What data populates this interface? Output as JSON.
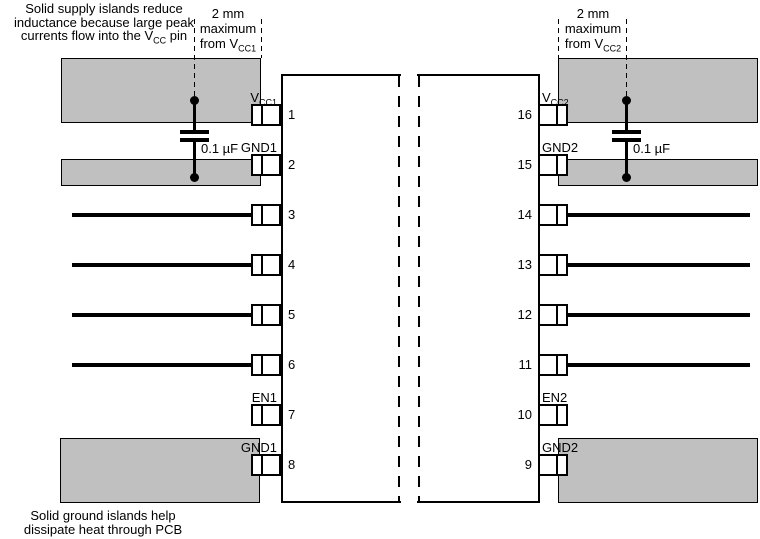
{
  "colors": {
    "island_fill": "#c0c0c0",
    "outline": "#000000",
    "background": "#ffffff"
  },
  "notes": {
    "supply": {
      "line1": "Solid supply islands reduce",
      "line2": "inductance because large peak",
      "line3_pre": "currents flow into the V",
      "line3_sub": "CC",
      "line3_post": " pin"
    },
    "ground": {
      "line1": "Solid ground islands help",
      "line2": "dissipate heat through PCB"
    }
  },
  "dimension_notes": {
    "left": {
      "line1": "2 mm",
      "line2": "maximum",
      "line3_pre": "from V",
      "line3_sub": "CC1"
    },
    "right": {
      "line1": "2 mm",
      "line2": "maximum",
      "line3_pre": "from V",
      "line3_sub": "CC2"
    }
  },
  "capacitors": {
    "left_value": "0.1 µF",
    "right_value": "0.1 µF"
  },
  "pins": {
    "left": [
      {
        "num": "1",
        "label_pre": "V",
        "label_sub": "CC1"
      },
      {
        "num": "2",
        "label_pre": "GND1"
      },
      {
        "num": "3"
      },
      {
        "num": "4"
      },
      {
        "num": "5"
      },
      {
        "num": "6"
      },
      {
        "num": "7",
        "label_pre": "EN1"
      },
      {
        "num": "8",
        "label_pre": "GND1"
      }
    ],
    "right": [
      {
        "num": "16",
        "label_pre": "V",
        "label_sub": "CC2"
      },
      {
        "num": "15",
        "label_pre": "GND2"
      },
      {
        "num": "14"
      },
      {
        "num": "13"
      },
      {
        "num": "12"
      },
      {
        "num": "11"
      },
      {
        "num": "10",
        "label_pre": "EN2"
      },
      {
        "num": "9",
        "label_pre": "GND2"
      }
    ]
  }
}
